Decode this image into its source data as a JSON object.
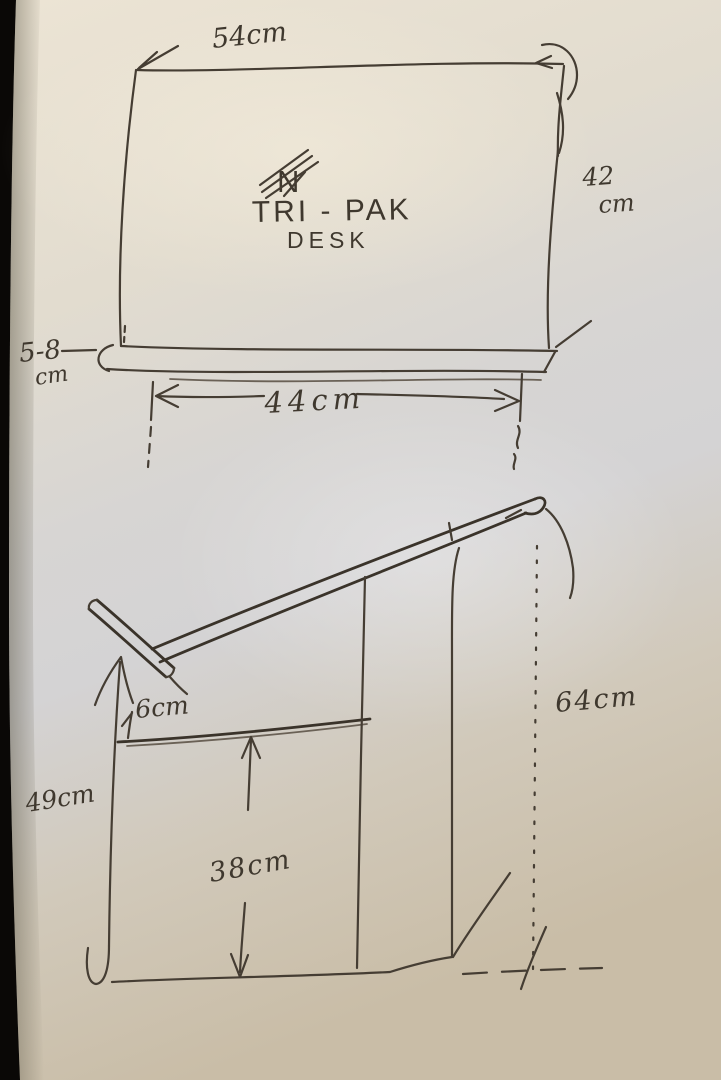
{
  "scene": {
    "description": "Hand-drawn ink sketch on paper of TRI-PAK desk dimensions, two views",
    "background_color": "#0a0806",
    "paper_color": "#ddd6c8",
    "ink_color": "#453d33"
  },
  "title": {
    "line1": "TRI - PAK",
    "line2": "DESK",
    "crossed_out_letter": "N"
  },
  "top_view": {
    "width_label": "54cm",
    "depth_value": "42",
    "depth_unit": "cm",
    "lip_value": "5-8",
    "lip_unit": "cm",
    "inner_width_label": "44cm"
  },
  "side_view": {
    "lip_height_label": "6cm",
    "front_height_label": "49cm",
    "under_shelf_label": "38cm",
    "back_height_label": "64cm"
  }
}
